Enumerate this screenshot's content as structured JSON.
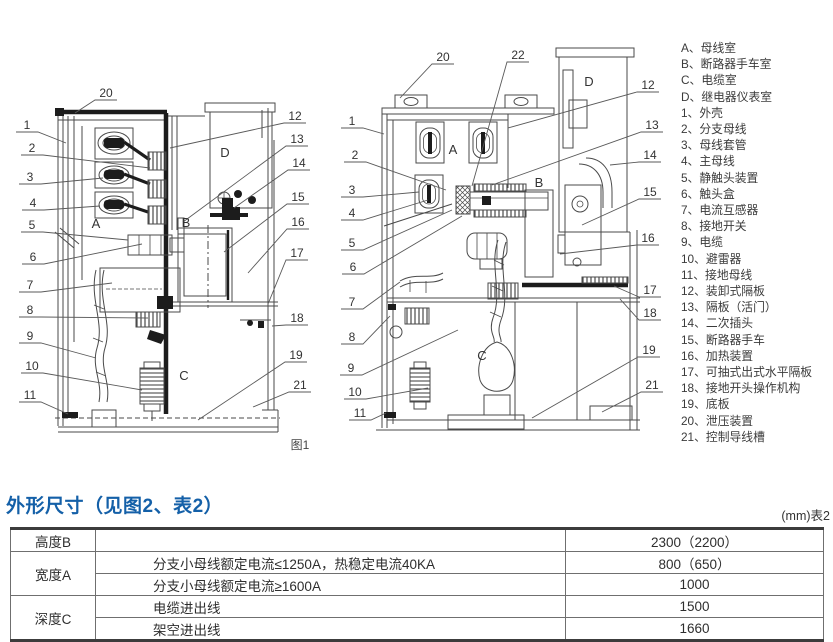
{
  "figure": {
    "caption": "图1",
    "left": {
      "letters": [
        {
          "t": "A",
          "x": 96,
          "y": 148
        },
        {
          "t": "B",
          "x": 186,
          "y": 147
        },
        {
          "t": "D",
          "x": 225,
          "y": 77
        },
        {
          "t": "C",
          "x": 184,
          "y": 300
        }
      ],
      "callouts": [
        {
          "n": "20",
          "x": 106,
          "y": 13,
          "tx": 75,
          "ty": 33
        },
        {
          "n": "1",
          "x": 27,
          "y": 45,
          "tx": 66,
          "ty": 63
        },
        {
          "n": "2",
          "x": 32,
          "y": 68,
          "tx": 150,
          "ty": 88
        },
        {
          "n": "3",
          "x": 30,
          "y": 97,
          "tx": 103,
          "ty": 98
        },
        {
          "n": "4",
          "x": 33,
          "y": 123,
          "tx": 100,
          "ty": 126
        },
        {
          "n": "5",
          "x": 32,
          "y": 145,
          "tx": 128,
          "ty": 160
        },
        {
          "n": "6",
          "x": 33,
          "y": 177,
          "tx": 142,
          "ty": 164
        },
        {
          "n": "7",
          "x": 30,
          "y": 205,
          "tx": 112,
          "ty": 203
        },
        {
          "n": "8",
          "x": 30,
          "y": 230,
          "tx": 148,
          "ty": 238
        },
        {
          "n": "9",
          "x": 30,
          "y": 256,
          "tx": 96,
          "ty": 278
        },
        {
          "n": "10",
          "x": 32,
          "y": 286,
          "tx": 142,
          "ty": 310
        },
        {
          "n": "11",
          "x": 30,
          "y": 315,
          "tx": 68,
          "ty": 334
        },
        {
          "n": "12",
          "x": 295,
          "y": 36,
          "tx": 170,
          "ty": 68
        },
        {
          "n": "13",
          "x": 297,
          "y": 59,
          "tx": 183,
          "ty": 142
        },
        {
          "n": "14",
          "x": 299,
          "y": 83,
          "tx": 234,
          "ty": 128
        },
        {
          "n": "15",
          "x": 298,
          "y": 117,
          "tx": 224,
          "ty": 172
        },
        {
          "n": "16",
          "x": 298,
          "y": 142,
          "tx": 248,
          "ty": 193
        },
        {
          "n": "17",
          "x": 297,
          "y": 173,
          "tx": 268,
          "ty": 224
        },
        {
          "n": "18",
          "x": 297,
          "y": 238,
          "tx": 272,
          "ty": 246
        },
        {
          "n": "19",
          "x": 296,
          "y": 275,
          "tx": 198,
          "ty": 340
        },
        {
          "n": "21",
          "x": 300,
          "y": 305,
          "tx": 253,
          "ty": 327
        }
      ]
    },
    "right": {
      "letters": [
        {
          "t": "A",
          "x": 123,
          "y": 114
        },
        {
          "t": "B",
          "x": 209,
          "y": 147
        },
        {
          "t": "D",
          "x": 259,
          "y": 46
        },
        {
          "t": "C",
          "x": 152,
          "y": 320
        }
      ],
      "callouts": [
        {
          "n": "20",
          "x": 113,
          "y": 17,
          "tx": 70,
          "ty": 58
        },
        {
          "n": "22",
          "x": 188,
          "y": 15,
          "tx": 142,
          "ty": 146
        },
        {
          "n": "1",
          "x": 22,
          "y": 81,
          "tx": 54,
          "ty": 94
        },
        {
          "n": "2",
          "x": 25,
          "y": 115,
          "tx": 116,
          "ty": 150
        },
        {
          "n": "3",
          "x": 22,
          "y": 150,
          "tx": 89,
          "ty": 152
        },
        {
          "n": "4",
          "x": 22,
          "y": 173,
          "tx": 98,
          "ty": 160
        },
        {
          "n": "5",
          "x": 22,
          "y": 203,
          "tx": 122,
          "ty": 170
        },
        {
          "n": "6",
          "x": 23,
          "y": 227,
          "tx": 132,
          "ty": 176
        },
        {
          "n": "7",
          "x": 22,
          "y": 262,
          "tx": 70,
          "ty": 242
        },
        {
          "n": "8",
          "x": 22,
          "y": 297,
          "tx": 60,
          "ty": 276
        },
        {
          "n": "9",
          "x": 21,
          "y": 328,
          "tx": 128,
          "ty": 290
        },
        {
          "n": "10",
          "x": 25,
          "y": 352,
          "tx": 98,
          "ty": 348
        },
        {
          "n": "11",
          "x": 30,
          "y": 373,
          "tx": 56,
          "ty": 373
        },
        {
          "n": "12",
          "x": 318,
          "y": 45,
          "tx": 178,
          "ty": 88
        },
        {
          "n": "13",
          "x": 322,
          "y": 85,
          "tx": 162,
          "ty": 145
        },
        {
          "n": "14",
          "x": 320,
          "y": 115,
          "tx": 280,
          "ty": 125
        },
        {
          "n": "15",
          "x": 320,
          "y": 152,
          "tx": 252,
          "ty": 185
        },
        {
          "n": "16",
          "x": 318,
          "y": 198,
          "tx": 230,
          "ty": 214
        },
        {
          "n": "17",
          "x": 320,
          "y": 250,
          "tx": 284,
          "ty": 246
        },
        {
          "n": "18",
          "x": 320,
          "y": 273,
          "tx": 290,
          "ty": 259
        },
        {
          "n": "19",
          "x": 319,
          "y": 310,
          "tx": 202,
          "ty": 378
        },
        {
          "n": "21",
          "x": 322,
          "y": 345,
          "tx": 272,
          "ty": 372
        }
      ]
    }
  },
  "legend": {
    "items": [
      "A、母线室",
      "B、断路器手车室",
      "C、电缆室",
      "D、继电器仪表室",
      "1、外壳",
      "2、分支母线",
      "3、母线套管",
      "4、主母线",
      "5、静触头装置",
      "6、触头盒",
      "7、电流互感器",
      "8、接地开关",
      "9、电缆",
      "10、避雷器",
      "11、接地母线",
      "12、装卸式隔板",
      "13、隔板（活门）",
      "14、二次插头",
      "15、断路器手车",
      "16、加热装置",
      "17、可抽式出式水平隔板",
      "18、接地开头操作机构",
      "19、底板",
      "20、泄压装置",
      "21、控制导线槽"
    ]
  },
  "section": {
    "title": "外形尺寸（见图2、表2）",
    "unit_note": "(mm)表2"
  },
  "table": {
    "rows": [
      {
        "dim": "高度B",
        "cond": "",
        "value": "2300（2200）"
      },
      {
        "dim": "宽度A",
        "cond": "分支小母线额定电流≤1250A，热稳定电流40KA",
        "value": "800（650）"
      },
      {
        "dim": "",
        "cond": "分支小母线额定电流≥1600A",
        "value": "1000"
      },
      {
        "dim": "深度C",
        "cond": "电缆进出线",
        "value": "1500"
      },
      {
        "dim": "",
        "cond": "架空进出线",
        "value": "1660"
      }
    ]
  },
  "colors": {
    "accent": "#1460a8",
    "line": "#4a4a4a"
  }
}
